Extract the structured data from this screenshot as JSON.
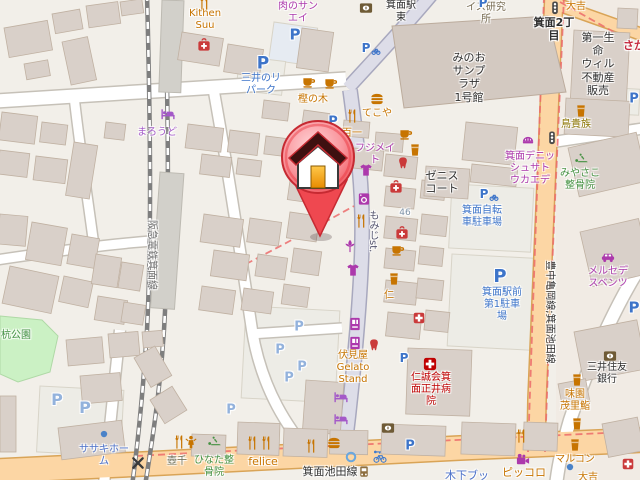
{
  "map": {
    "palette": {
      "food": "#C77400",
      "shop": "#AC39AC",
      "parking": "#3D74C9",
      "parkingPale": "#93B2DC",
      "company": "#4A6FC8",
      "health": "#CA3A3A",
      "hospital": "#BF0000",
      "green": "#449141",
      "olive": "#8B7500",
      "darkolive": "#6B6B52",
      "office": "#75694F",
      "black": "#2F2F2F",
      "roadname": "#54546E",
      "railname": "#6E6E6E",
      "housenum": "#7E93A8",
      "hotel": "#A459C8",
      "bank": "#6F5B36",
      "blue": "#3F7BD0",
      "signal": "#4A4A4A",
      "redshop": "#C5283D",
      "parkgreen": "#3E8E3E",
      "poiBrown": "#8D6E3F",
      "road_secondary": "#FCD6A4",
      "road_pedestrian": "#DDDDE8",
      "building": "#D9D0C9",
      "boundary": "#EC6B6B",
      "pin_red": "#EF4850",
      "pin_door": "#F2A31B"
    },
    "marker": {
      "name": "house-location-pin"
    },
    "labels": [
      {
        "lines": [
          "Kithen",
          "Suu"
        ],
        "x": 205,
        "y": 8,
        "color": "food"
      },
      {
        "lines": [
          "肉のサン",
          "エイ"
        ],
        "x": 298,
        "y": 1,
        "color": "shop"
      },
      {
        "lines": [
          "箕面駅",
          "東"
        ],
        "x": 401,
        "y": 0,
        "color": "black"
      },
      {
        "lines": [
          "イス研究",
          "所"
        ],
        "x": 486,
        "y": 2,
        "color": "office"
      },
      {
        "lines": [
          "大吉"
        ],
        "x": 576,
        "y": 1,
        "color": "food"
      },
      {
        "lines": [
          "箕面2丁",
          "目"
        ],
        "x": 554,
        "y": 16,
        "color": "black",
        "size": 11,
        "bold": true
      },
      {
        "lines": [
          "第一生",
          "命",
          "ウィル",
          "不動産",
          "販売"
        ],
        "x": 598,
        "y": 31,
        "color": "black",
        "size": 11
      },
      {
        "lines": [
          "さか"
        ],
        "x": 634,
        "y": 39,
        "color": "redshop",
        "size": 11,
        "bold": true
      },
      {
        "lines": [
          "みのお",
          "サンプ",
          "ラザ",
          "1号館"
        ],
        "x": 469,
        "y": 51,
        "color": "black",
        "size": 11
      },
      {
        "lines": [
          "三井のリ",
          "パーク"
        ],
        "x": 261,
        "y": 73,
        "color": "parking"
      },
      {
        "lines": [
          "まろうど"
        ],
        "x": 157,
        "y": 127,
        "color": "hotel"
      },
      {
        "lines": [
          "樫の木"
        ],
        "x": 313,
        "y": 94,
        "color": "food"
      },
      {
        "lines": [
          "てこや"
        ],
        "x": 377,
        "y": 108,
        "color": "food"
      },
      {
        "lines": [
          "百一"
        ],
        "x": 352,
        "y": 128,
        "color": "food"
      },
      {
        "lines": [
          "フジメイ",
          "ト"
        ],
        "x": 375,
        "y": 143,
        "color": "shop"
      },
      {
        "lines": [
          "ゼニス",
          "コート"
        ],
        "x": 442,
        "y": 169,
        "color": "black",
        "size": 11
      },
      {
        "lines": [
          "46"
        ],
        "x": 405,
        "y": 208,
        "color": "housenum",
        "size": 9
      },
      {
        "lines": [
          "箕面自転",
          "車駐車場"
        ],
        "x": 482,
        "y": 205,
        "color": "parking"
      },
      {
        "lines": [
          "箕面デニッ",
          "シュサト",
          "ウカエデ"
        ],
        "x": 530,
        "y": 151,
        "color": "shop"
      },
      {
        "lines": [
          "みやさこ",
          "整骨院"
        ],
        "x": 580,
        "y": 168,
        "color": "green"
      },
      {
        "lines": [
          "鳥貴族"
        ],
        "x": 576,
        "y": 119,
        "color": "olive"
      },
      {
        "lines": [
          "メルセデ",
          "スベンツ"
        ],
        "x": 608,
        "y": 266,
        "color": "shop"
      },
      {
        "lines": [
          "箕面駅前",
          "第1駐車",
          "場"
        ],
        "x": 502,
        "y": 287,
        "color": "parking"
      },
      {
        "lines": [
          "仁"
        ],
        "x": 389,
        "y": 290,
        "color": "food"
      },
      {
        "lines": [
          "伏見屋",
          "Gelato",
          "Stand"
        ],
        "x": 353,
        "y": 350,
        "color": "food"
      },
      {
        "lines": [
          "仁誠会箕",
          "面正井病",
          "院"
        ],
        "x": 431,
        "y": 372,
        "color": "hospital"
      },
      {
        "lines": [
          "ひなた整",
          "骨院"
        ],
        "x": 214,
        "y": 455,
        "color": "green"
      },
      {
        "lines": [
          "壺千"
        ],
        "x": 177,
        "y": 456,
        "color": "darkolive"
      },
      {
        "lines": [
          "felice"
        ],
        "x": 263,
        "y": 455,
        "color": "food",
        "size": 11
      },
      {
        "lines": [
          "ササキホー",
          "ム"
        ],
        "x": 104,
        "y": 444,
        "color": "company"
      },
      {
        "lines": [
          "杭公園"
        ],
        "x": 16,
        "y": 330,
        "color": "parkgreen"
      },
      {
        "lines": [
          "箕面池田線"
        ],
        "x": 330,
        "y": 465,
        "color": "black",
        "size": 11
      },
      {
        "lines": [
          "木下ブッ"
        ],
        "x": 467,
        "y": 469,
        "color": "company",
        "size": 11
      },
      {
        "lines": [
          "ピッコロ"
        ],
        "x": 524,
        "y": 466,
        "color": "food",
        "size": 11
      },
      {
        "lines": [
          "マルコン"
        ],
        "x": 575,
        "y": 454,
        "color": "food"
      },
      {
        "lines": [
          "大吉"
        ],
        "x": 588,
        "y": 472,
        "color": "food"
      },
      {
        "lines": [
          "三井住友",
          "銀行"
        ],
        "x": 607,
        "y": 362,
        "color": "black"
      },
      {
        "lines": [
          "味園",
          "茂里鮨"
        ],
        "x": 575,
        "y": 389,
        "color": "food"
      },
      {
        "lines": [
          "もみじst."
        ],
        "x": 372,
        "y": 210,
        "color": "roadname",
        "mode": "v"
      },
      {
        "lines": [
          "阪急電鉄箕面線"
        ],
        "x": 151,
        "y": 255,
        "color": "railname",
        "mode": "r90"
      },
      {
        "lines": [
          "豊中亀岡線;箕面池田線"
        ],
        "x": 549,
        "y": 312,
        "color": "black",
        "mode": "r90"
      }
    ],
    "icons": [
      {
        "type": "restaurant",
        "x": 204,
        "y": 3
      },
      {
        "type": "pharmacy",
        "x": 204,
        "y": 45
      },
      {
        "type": "parking",
        "glyph": "P",
        "x": 295,
        "y": 35,
        "size": 15
      },
      {
        "type": "parking",
        "glyph": "P",
        "x": 263,
        "y": 64,
        "size": 17
      },
      {
        "type": "parking-bicycle",
        "glyph": "P",
        "x": 366,
        "y": 48,
        "size": 12
      },
      {
        "type": "parking",
        "glyph": "P",
        "x": 333,
        "y": 122,
        "size": 13
      },
      {
        "type": "parking",
        "glyph": "P",
        "x": 483,
        "y": 3,
        "size": 12
      },
      {
        "type": "cafe",
        "x": 309,
        "y": 81
      },
      {
        "type": "cafe",
        "x": 331,
        "y": 82
      },
      {
        "type": "hotel",
        "x": 168,
        "y": 114
      },
      {
        "type": "bank",
        "x": 366,
        "y": 8
      },
      {
        "type": "traffic-signal",
        "x": 555,
        "y": 8
      },
      {
        "type": "traffic-signal",
        "x": 552,
        "y": 138
      },
      {
        "type": "drink",
        "x": 581,
        "y": 111
      },
      {
        "type": "restaurant",
        "x": 352,
        "y": 116
      },
      {
        "type": "fastfood",
        "x": 377,
        "y": 99
      },
      {
        "type": "clothes",
        "x": 366,
        "y": 170
      },
      {
        "type": "laundry",
        "x": 364,
        "y": 199
      },
      {
        "type": "restaurant",
        "x": 361,
        "y": 221
      },
      {
        "type": "florist",
        "x": 350,
        "y": 246
      },
      {
        "type": "clothes",
        "x": 353,
        "y": 270
      },
      {
        "type": "cafe",
        "x": 406,
        "y": 133
      },
      {
        "type": "drink",
        "x": 415,
        "y": 150
      },
      {
        "type": "dentist",
        "x": 403,
        "y": 163
      },
      {
        "type": "pharmacy",
        "x": 396,
        "y": 187
      },
      {
        "type": "pharmacy",
        "x": 402,
        "y": 233
      },
      {
        "type": "cafe",
        "x": 398,
        "y": 249
      },
      {
        "type": "drink",
        "x": 394,
        "y": 279
      },
      {
        "type": "clinic",
        "x": 419,
        "y": 318,
        "size": 13
      },
      {
        "type": "bakery",
        "x": 528,
        "y": 140
      },
      {
        "type": "massage",
        "x": 581,
        "y": 159
      },
      {
        "type": "car-dealer",
        "x": 608,
        "y": 257
      },
      {
        "type": "parking",
        "glyph": "P",
        "x": 500,
        "y": 277,
        "size": 18
      },
      {
        "type": "parking-bicycle",
        "glyph": "P",
        "x": 484,
        "y": 194,
        "size": 12
      },
      {
        "type": "vending-machine",
        "x": 355,
        "y": 324
      },
      {
        "type": "vending-machine",
        "x": 355,
        "y": 343
      },
      {
        "type": "dentist",
        "x": 374,
        "y": 345
      },
      {
        "type": "hotel",
        "x": 341,
        "y": 397
      },
      {
        "type": "hotel",
        "x": 341,
        "y": 419
      },
      {
        "type": "parking",
        "glyph": "P",
        "x": 299,
        "y": 327,
        "size": 13,
        "tone": "pale"
      },
      {
        "type": "parking",
        "glyph": "P",
        "x": 280,
        "y": 350,
        "size": 13,
        "tone": "pale"
      },
      {
        "type": "parking",
        "glyph": "P",
        "x": 302,
        "y": 367,
        "size": 13,
        "tone": "pale"
      },
      {
        "type": "parking",
        "glyph": "P",
        "x": 289,
        "y": 378,
        "size": 13,
        "tone": "pale"
      },
      {
        "type": "parking",
        "glyph": "P",
        "x": 231,
        "y": 410,
        "size": 13,
        "tone": "pale"
      },
      {
        "type": "parking",
        "glyph": "P",
        "x": 57,
        "y": 400,
        "size": 16,
        "tone": "pale"
      },
      {
        "type": "parking",
        "glyph": "P",
        "x": 85,
        "y": 408,
        "size": 16,
        "tone": "pale"
      },
      {
        "type": "dot",
        "x": 104,
        "y": 434
      },
      {
        "type": "railway-crossing",
        "x": 138,
        "y": 463
      },
      {
        "type": "restaurant",
        "x": 179,
        "y": 442
      },
      {
        "type": "person",
        "x": 191,
        "y": 442
      },
      {
        "type": "massage",
        "x": 214,
        "y": 442
      },
      {
        "type": "restaurant",
        "x": 252,
        "y": 443
      },
      {
        "type": "restaurant",
        "x": 266,
        "y": 443
      },
      {
        "type": "restaurant",
        "x": 311,
        "y": 446
      },
      {
        "type": "fastfood",
        "x": 334,
        "y": 443
      },
      {
        "type": "bank",
        "x": 388,
        "y": 428
      },
      {
        "type": "fountain",
        "x": 351,
        "y": 457
      },
      {
        "type": "bicycle-rental",
        "x": 380,
        "y": 457
      },
      {
        "type": "parking",
        "glyph": "P",
        "x": 410,
        "y": 446,
        "size": 13
      },
      {
        "type": "restaurant",
        "x": 521,
        "y": 436
      },
      {
        "type": "cinema",
        "x": 523,
        "y": 460
      },
      {
        "type": "drink",
        "x": 577,
        "y": 380
      },
      {
        "type": "drink",
        "x": 577,
        "y": 424
      },
      {
        "type": "drink",
        "x": 575,
        "y": 445
      },
      {
        "type": "dot",
        "x": 570,
        "y": 467
      },
      {
        "type": "clinic",
        "x": 628,
        "y": 464,
        "size": 13
      },
      {
        "type": "bank",
        "x": 610,
        "y": 356
      },
      {
        "type": "hospital",
        "x": 430,
        "y": 364,
        "size": 15
      },
      {
        "type": "parking",
        "glyph": "P",
        "x": 404,
        "y": 358,
        "size": 12
      },
      {
        "type": "parking",
        "glyph": "P",
        "x": 634,
        "y": 308,
        "size": 15
      },
      {
        "type": "parking",
        "glyph": "P",
        "x": 634,
        "y": 99,
        "size": 13
      },
      {
        "type": "bus-stop",
        "x": 364,
        "y": 472
      }
    ]
  }
}
